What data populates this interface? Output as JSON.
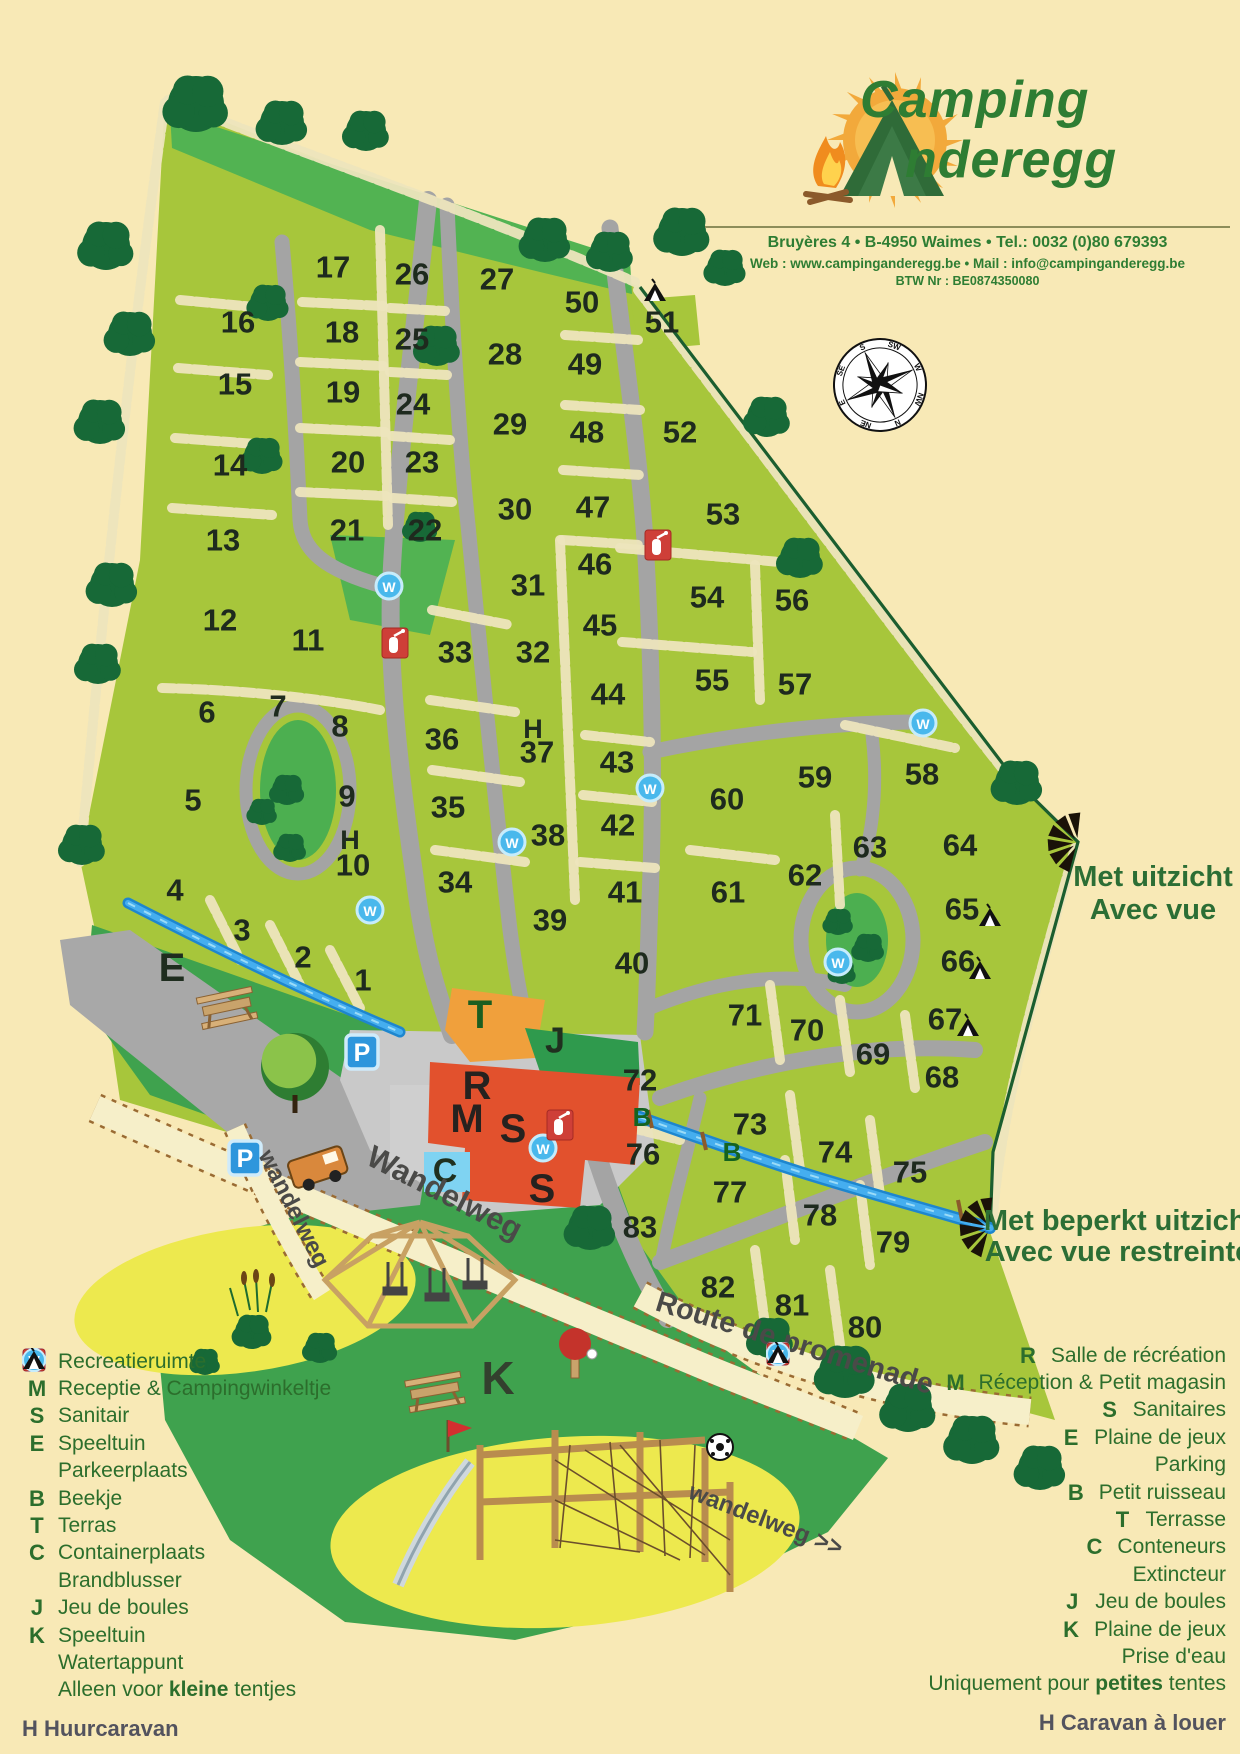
{
  "header": {
    "brand_line1": "Camping",
    "brand_line2": "nderegg",
    "address": "Bruyères 4 • B-4950 Waimes • Tel.: 0032 (0)80 679393",
    "web_mail": "Web : www.campinganderegg.be • Mail : info@campinganderegg.be",
    "vat": "BTW Nr : BE0874350080"
  },
  "colors": {
    "background": "#F8E9B6",
    "plot_green": "#A7C63B",
    "meadow_green": "#3FA24E",
    "tree_green": "#176937",
    "road_gray": "#A4A4A4",
    "plaza_gray": "#C9C9C9",
    "stream_blue": "#2FA0E8",
    "building_red": "#E2512D",
    "terrace_orange": "#F0A03C",
    "container_blue": "#7FD3F2",
    "legend_green": "#2C6E2C",
    "sand_yellow": "#EDE94E"
  },
  "map": {
    "plots": [
      {
        "n": "1",
        "x": 363,
        "y": 980
      },
      {
        "n": "2",
        "x": 303,
        "y": 957
      },
      {
        "n": "3",
        "x": 242,
        "y": 930
      },
      {
        "n": "4",
        "x": 175,
        "y": 890
      },
      {
        "n": "5",
        "x": 193,
        "y": 800
      },
      {
        "n": "6",
        "x": 207,
        "y": 712
      },
      {
        "n": "7",
        "x": 278,
        "y": 706
      },
      {
        "n": "8",
        "x": 340,
        "y": 726
      },
      {
        "n": "9",
        "x": 347,
        "y": 796
      },
      {
        "n": "10",
        "x": 353,
        "y": 865
      },
      {
        "n": "11",
        "x": 308,
        "y": 640
      },
      {
        "n": "12",
        "x": 220,
        "y": 620
      },
      {
        "n": "13",
        "x": 223,
        "y": 540
      },
      {
        "n": "14",
        "x": 230,
        "y": 465
      },
      {
        "n": "15",
        "x": 235,
        "y": 384
      },
      {
        "n": "16",
        "x": 238,
        "y": 322
      },
      {
        "n": "17",
        "x": 333,
        "y": 267
      },
      {
        "n": "18",
        "x": 342,
        "y": 332
      },
      {
        "n": "19",
        "x": 343,
        "y": 392
      },
      {
        "n": "20",
        "x": 348,
        "y": 462
      },
      {
        "n": "21",
        "x": 347,
        "y": 530
      },
      {
        "n": "22",
        "x": 425,
        "y": 530
      },
      {
        "n": "23",
        "x": 422,
        "y": 462
      },
      {
        "n": "24",
        "x": 413,
        "y": 404
      },
      {
        "n": "25",
        "x": 412,
        "y": 339
      },
      {
        "n": "26",
        "x": 412,
        "y": 274
      },
      {
        "n": "27",
        "x": 497,
        "y": 279
      },
      {
        "n": "28",
        "x": 505,
        "y": 354
      },
      {
        "n": "29",
        "x": 510,
        "y": 424
      },
      {
        "n": "30",
        "x": 515,
        "y": 509
      },
      {
        "n": "31",
        "x": 528,
        "y": 585
      },
      {
        "n": "32",
        "x": 533,
        "y": 652
      },
      {
        "n": "33",
        "x": 455,
        "y": 652
      },
      {
        "n": "34",
        "x": 455,
        "y": 882
      },
      {
        "n": "35",
        "x": 448,
        "y": 807
      },
      {
        "n": "36",
        "x": 442,
        "y": 739
      },
      {
        "n": "37",
        "x": 537,
        "y": 752
      },
      {
        "n": "38",
        "x": 548,
        "y": 835
      },
      {
        "n": "39",
        "x": 550,
        "y": 920
      },
      {
        "n": "40",
        "x": 632,
        "y": 963
      },
      {
        "n": "41",
        "x": 625,
        "y": 892
      },
      {
        "n": "42",
        "x": 618,
        "y": 825
      },
      {
        "n": "43",
        "x": 617,
        "y": 762
      },
      {
        "n": "44",
        "x": 608,
        "y": 694
      },
      {
        "n": "45",
        "x": 600,
        "y": 625
      },
      {
        "n": "46",
        "x": 595,
        "y": 564
      },
      {
        "n": "47",
        "x": 593,
        "y": 507
      },
      {
        "n": "48",
        "x": 587,
        "y": 432
      },
      {
        "n": "49",
        "x": 585,
        "y": 364
      },
      {
        "n": "50",
        "x": 582,
        "y": 302
      },
      {
        "n": "51",
        "x": 662,
        "y": 322
      },
      {
        "n": "52",
        "x": 680,
        "y": 432
      },
      {
        "n": "53",
        "x": 723,
        "y": 514
      },
      {
        "n": "54",
        "x": 707,
        "y": 597
      },
      {
        "n": "55",
        "x": 712,
        "y": 680
      },
      {
        "n": "56",
        "x": 792,
        "y": 600
      },
      {
        "n": "57",
        "x": 795,
        "y": 684
      },
      {
        "n": "58",
        "x": 922,
        "y": 774
      },
      {
        "n": "59",
        "x": 815,
        "y": 777
      },
      {
        "n": "60",
        "x": 727,
        "y": 799
      },
      {
        "n": "61",
        "x": 728,
        "y": 892
      },
      {
        "n": "62",
        "x": 805,
        "y": 875
      },
      {
        "n": "63",
        "x": 870,
        "y": 847
      },
      {
        "n": "64",
        "x": 960,
        "y": 845
      },
      {
        "n": "65",
        "x": 962,
        "y": 909
      },
      {
        "n": "66",
        "x": 958,
        "y": 961
      },
      {
        "n": "67",
        "x": 945,
        "y": 1019
      },
      {
        "n": "68",
        "x": 942,
        "y": 1077
      },
      {
        "n": "69",
        "x": 873,
        "y": 1054
      },
      {
        "n": "70",
        "x": 807,
        "y": 1030
      },
      {
        "n": "71",
        "x": 745,
        "y": 1015
      },
      {
        "n": "72",
        "x": 640,
        "y": 1080
      },
      {
        "n": "73",
        "x": 750,
        "y": 1124
      },
      {
        "n": "74",
        "x": 835,
        "y": 1152
      },
      {
        "n": "75",
        "x": 910,
        "y": 1172
      },
      {
        "n": "76",
        "x": 643,
        "y": 1154
      },
      {
        "n": "77",
        "x": 730,
        "y": 1192
      },
      {
        "n": "78",
        "x": 820,
        "y": 1215
      },
      {
        "n": "79",
        "x": 893,
        "y": 1242
      },
      {
        "n": "80",
        "x": 865,
        "y": 1327
      },
      {
        "n": "81",
        "x": 792,
        "y": 1305
      },
      {
        "n": "82",
        "x": 718,
        "y": 1287
      },
      {
        "n": "83",
        "x": 640,
        "y": 1227
      }
    ],
    "facility_letters": [
      {
        "t": "E",
        "x": 172,
        "y": 968,
        "s": 40,
        "c": "#1F2D1F"
      },
      {
        "t": "H",
        "x": 350,
        "y": 840,
        "s": 27,
        "c": "#1F2D1F"
      },
      {
        "t": "H",
        "x": 533,
        "y": 729,
        "s": 27,
        "c": "#1F2D1F"
      },
      {
        "t": "T",
        "x": 480,
        "y": 1015,
        "s": 40,
        "c": "#1B5E20"
      },
      {
        "t": "J",
        "x": 555,
        "y": 1040,
        "s": 36,
        "c": "#20301F"
      },
      {
        "t": "R",
        "x": 477,
        "y": 1086,
        "s": 40,
        "c": "#26221F"
      },
      {
        "t": "M",
        "x": 467,
        "y": 1119,
        "s": 40,
        "c": "#26221F"
      },
      {
        "t": "S",
        "x": 513,
        "y": 1129,
        "s": 40,
        "c": "#26221F"
      },
      {
        "t": "S",
        "x": 542,
        "y": 1189,
        "s": 40,
        "c": "#26221F"
      },
      {
        "t": "C",
        "x": 445,
        "y": 1171,
        "s": 34,
        "c": "#20301F"
      },
      {
        "t": "K",
        "x": 498,
        "y": 1378,
        "s": 46,
        "c": "#33402E"
      },
      {
        "t": "B",
        "x": 642,
        "y": 1117,
        "s": 26,
        "c": "#15631F"
      },
      {
        "t": "B",
        "x": 732,
        "y": 1152,
        "s": 26,
        "c": "#15631F"
      }
    ],
    "water_points": [
      [
        389,
        586
      ],
      [
        512,
        842
      ],
      [
        370,
        910
      ],
      [
        650,
        788
      ],
      [
        838,
        962
      ],
      [
        923,
        723
      ],
      [
        543,
        1148
      ]
    ],
    "extinguishers": [
      [
        395,
        643
      ],
      [
        658,
        545
      ],
      [
        560,
        1125
      ]
    ],
    "parking_signs": [
      [
        362,
        1052
      ],
      [
        245,
        1158
      ]
    ],
    "small_tent_pitches": [
      [
        655,
        292
      ],
      [
        990,
        917
      ],
      [
        980,
        970
      ],
      [
        968,
        1027
      ]
    ],
    "view_markers": [
      [
        1078,
        843
      ],
      [
        990,
        1228
      ]
    ],
    "trees": [
      [
        196,
        104,
        28
      ],
      [
        282,
        123,
        22
      ],
      [
        366,
        131,
        20
      ],
      [
        545,
        240,
        22
      ],
      [
        610,
        252,
        20
      ],
      [
        682,
        232,
        24
      ],
      [
        725,
        268,
        18
      ],
      [
        106,
        246,
        24
      ],
      [
        130,
        334,
        22
      ],
      [
        100,
        422,
        22
      ],
      [
        112,
        585,
        22
      ],
      [
        98,
        664,
        20
      ],
      [
        82,
        845,
        20
      ],
      [
        268,
        303,
        18
      ],
      [
        262,
        456,
        18
      ],
      [
        437,
        346,
        20
      ],
      [
        420,
        527,
        15
      ],
      [
        1017,
        783,
        22
      ],
      [
        767,
        417,
        20
      ],
      [
        800,
        558,
        20
      ],
      [
        287,
        790,
        15
      ],
      [
        262,
        812,
        13
      ],
      [
        290,
        848,
        14
      ],
      [
        838,
        922,
        13
      ],
      [
        868,
        948,
        14
      ],
      [
        842,
        972,
        12
      ],
      [
        590,
        1228,
        22
      ],
      [
        845,
        1372,
        26
      ],
      [
        908,
        1408,
        24
      ],
      [
        972,
        1440,
        24
      ],
      [
        1040,
        1468,
        22
      ],
      [
        770,
        1338,
        20
      ],
      [
        252,
        1332,
        17
      ],
      [
        320,
        1348,
        15
      ],
      [
        205,
        1362,
        13
      ]
    ],
    "big_tree": {
      "x": 295,
      "y": 1067,
      "r": 34
    },
    "road_labels": [
      {
        "text": "Wandelweg",
        "x": 440,
        "y": 1202,
        "rot": 27,
        "size": 31
      },
      {
        "text": "wandelweg",
        "x": 287,
        "y": 1212,
        "rot": 63,
        "size": 24
      },
      {
        "text": "Route de promenade",
        "x": 792,
        "y": 1352,
        "rot": 17,
        "size": 29
      },
      {
        "text": "wandelweg >>",
        "x": 763,
        "y": 1527,
        "rot": 21,
        "size": 24
      }
    ],
    "view_labels": [
      {
        "text": "Met uitzicht",
        "x": 1153,
        "y": 886
      },
      {
        "text": "Avec vue",
        "x": 1153,
        "y": 919
      },
      {
        "text": "Met beperkt uitzicht",
        "x": 1120,
        "y": 1230
      },
      {
        "text": "Avec vue restreinte",
        "x": 1118,
        "y": 1261
      }
    ],
    "compass": {
      "x": 880,
      "y": 385,
      "r": 46,
      "rotation": 155,
      "points": [
        "N",
        "NE",
        "E",
        "SE",
        "S",
        "SW",
        "W",
        "NW"
      ]
    }
  },
  "legend_left": {
    "items": [
      {
        "sym": "R",
        "label": "Recreatieruimte"
      },
      {
        "sym": "M",
        "label": "Receptie & Campingwinkeltje"
      },
      {
        "sym": "S",
        "label": "Sanitair"
      },
      {
        "sym": "E",
        "label": "Speeltuin"
      },
      {
        "icon": "parking",
        "label": "Parkeerplaats"
      },
      {
        "sym": "B",
        "label": "Beekje"
      },
      {
        "sym": "T",
        "label": "Terras"
      },
      {
        "sym": "C",
        "label": "Containerplaats"
      },
      {
        "icon": "extinguisher",
        "label": "Brandblusser"
      },
      {
        "sym": "J",
        "label": "Jeu de boules"
      },
      {
        "sym": "K",
        "label": "Speeltuin"
      },
      {
        "icon": "water",
        "label": "Watertappunt"
      },
      {
        "icon": "tent",
        "parts": [
          "Alleen voor ",
          "kleine",
          " tentjes"
        ]
      }
    ],
    "footer": "H Huurcaravan"
  },
  "legend_right": {
    "items": [
      {
        "sym": "R",
        "label": "Salle de récréation"
      },
      {
        "sym": "M",
        "label": "Réception & Petit magasin"
      },
      {
        "sym": "S",
        "label": "Sanitaires"
      },
      {
        "sym": "E",
        "label": "Plaine de jeux"
      },
      {
        "icon": "parking",
        "label": "Parking"
      },
      {
        "sym": "B",
        "label": "Petit ruisseau"
      },
      {
        "sym": "T",
        "label": "Terrasse"
      },
      {
        "sym": "C",
        "label": "Conteneurs"
      },
      {
        "icon": "extinguisher",
        "label": "Extincteur"
      },
      {
        "sym": "J",
        "label": "Jeu de boules"
      },
      {
        "sym": "K",
        "label": "Plaine de jeux"
      },
      {
        "icon": "water",
        "label": "Prise d'eau"
      },
      {
        "icon": "tent",
        "parts": [
          "Uniquement pour ",
          "petites",
          " tentes"
        ]
      }
    ],
    "footer": "H Caravan à louer"
  }
}
